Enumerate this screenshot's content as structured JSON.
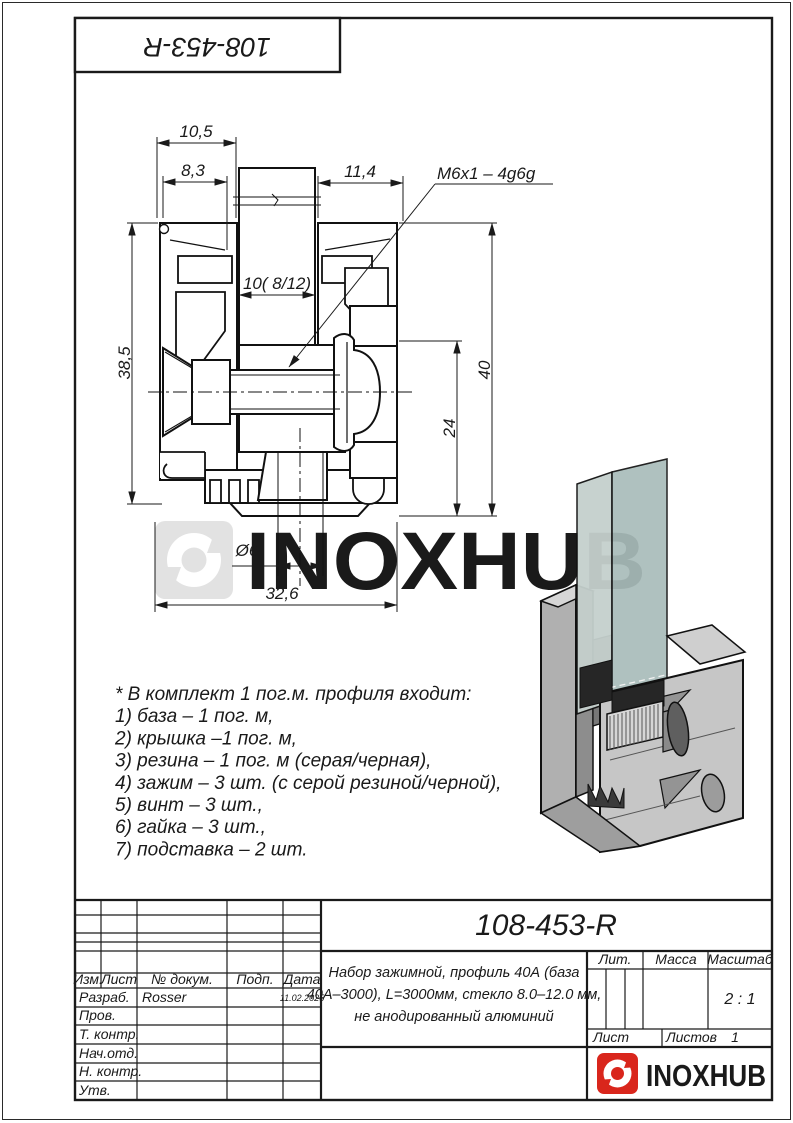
{
  "top_stamp": {
    "designation": "108-453-R"
  },
  "watermark": {
    "text": "INOXHUB"
  },
  "drawing": {
    "dimensions": {
      "top_width": "10,5",
      "flange_lip": "8,3",
      "right_offset": "11,4",
      "thread_callout": "M6x1 – 4g6g",
      "slot_width": "10( 8/12)",
      "height_inner": "38,5",
      "height_total": "40",
      "height_clamp": "24",
      "hole_diameter": "Ø6",
      "base_width": "32,6"
    }
  },
  "notes": {
    "lines": [
      "* В комплект 1 пог.м. профиля входит:",
      "1) база – 1 пог. м,",
      "2) крышка –1 пог. м,",
      "3) резина – 1 пог. м (серая/черная),",
      "4) зажим – 3 шт. (с серой резиной/черной),",
      "5) винт – 3 шт.,",
      "6) гайка – 3 шт.,",
      "7) подставка – 2 шт."
    ]
  },
  "title_block": {
    "designation": "108-453-R",
    "description_lines": [
      "Набор зажимной, профиль 40А (база",
      "40А–3000), L=3000мм, стекло 8.0–12.0 мм,",
      "не анодированный алюминий"
    ],
    "headers": {
      "izm": "Изм.",
      "list": "Лист",
      "doc_no": "№ докум.",
      "sign": "Подп.",
      "date": "Дата",
      "lit": "Лит.",
      "mass": "Масса",
      "scale": "Масштаб",
      "sheet": "Лист",
      "sheets": "Листов"
    },
    "rows": {
      "developed": "Разраб.",
      "checked": "Пров.",
      "t_control": "Т. контр.",
      "dept_head": "Нач.отд.",
      "n_control": "Н. контр.",
      "approved": "Утв."
    },
    "values": {
      "developer": "Rosser",
      "date": "11.02.2025",
      "scale": "2 : 1",
      "sheets_count": "1"
    },
    "logo_text": "INOXHUB"
  },
  "colors": {
    "line": "#1a1a1a",
    "watermark": "#e2e2e2",
    "logo_red": "#d9261c",
    "logo_text": "#3d3d3d",
    "glass_front": "#a9bcba",
    "glass_side": "#c5d0cd",
    "metal_light": "#c6c6c6",
    "metal_mid": "#b0b0b0",
    "metal_dark": "#8d8d8d"
  }
}
